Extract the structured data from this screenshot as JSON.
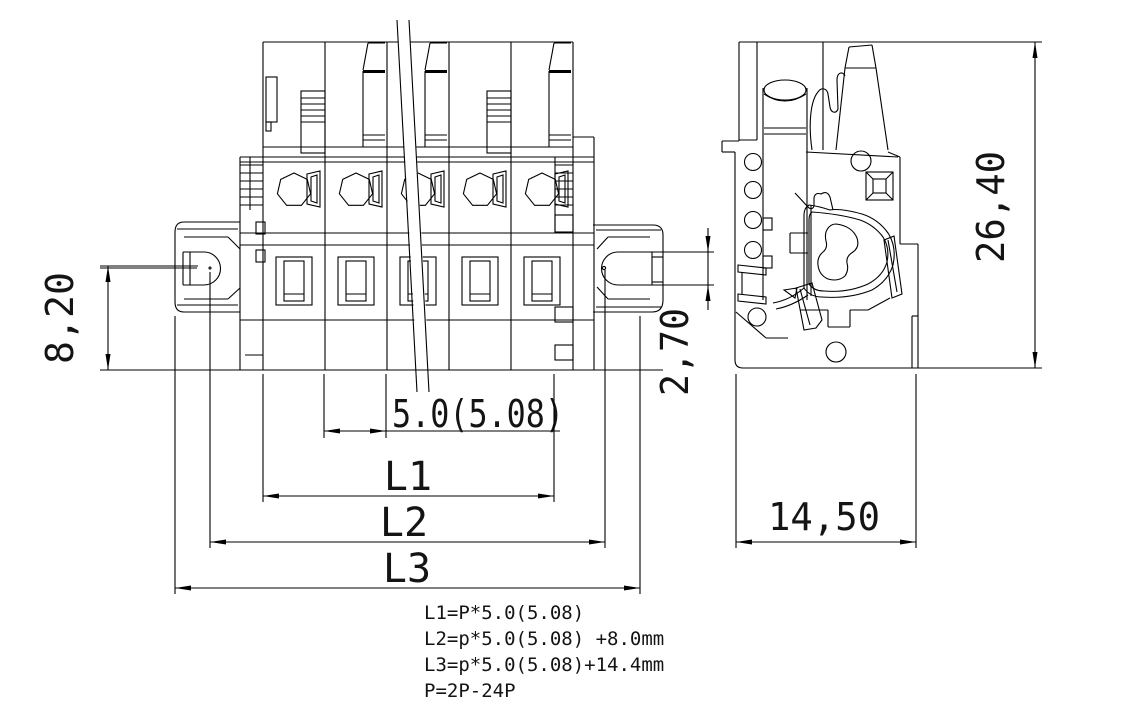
{
  "drawing": {
    "dimensions": {
      "pitch_label": "5.0(5.08)",
      "l1_label": "L1",
      "l2_label": "L2",
      "l3_label": "L3",
      "ear_center_height": "8,20",
      "overall_height": "26,40",
      "tab_thickness": "2,70",
      "overall_depth": "14,50"
    },
    "notes": {
      "line1": "L1=P*5.0(5.08)",
      "line2": "L2=p*5.0(5.08)  +8.0mm",
      "line3": "L3=p*5.0(5.08)+14.4mm",
      "line4": "P=2P-24P"
    },
    "colors": {
      "line": "#000000",
      "background": "#ffffff",
      "center_mark": "#ff0000",
      "hidden_edge": "#c9c9c9"
    }
  }
}
